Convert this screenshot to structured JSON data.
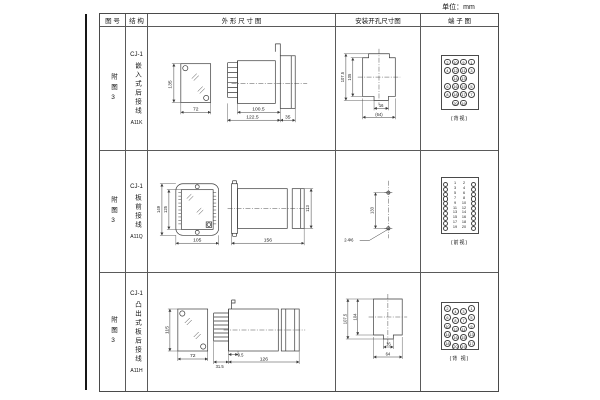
{
  "unit_label": "单位：mm",
  "header": {
    "col_fig": "图 号",
    "col_struct": "结 构",
    "col_outline": "外 形 尺 寸 图",
    "col_install": "安装开孔尺寸图",
    "col_terminal": "端 子 图"
  },
  "rows": [
    {
      "fig_no": "附图3",
      "model": "CJ-1",
      "mount": "嵌入式后接线",
      "code": "A11K",
      "outline": {
        "front_h": "135",
        "front_w": "72",
        "d1": "100.5",
        "d2": "122.5",
        "d3": "35"
      },
      "install": {
        "h1": "107.5",
        "h2": "105",
        "w1": "16",
        "w2": "(64)"
      },
      "terminal": {
        "caption": "(背视)",
        "grid": [
          "2",
          "10",
          "9",
          "1",
          "4",
          "12",
          "11",
          "3",
          "",
          "14",
          "13",
          "",
          "6",
          "16",
          "15",
          "5",
          "8",
          "18",
          "17",
          "7",
          "",
          "20",
          "19",
          ""
        ]
      }
    },
    {
      "fig_no": "附图3",
      "model": "CJ-1",
      "mount": "板前接线",
      "code": "A11Q",
      "outline": {
        "h1": "149",
        "h2": "125",
        "front_w": "105",
        "side_l": "156",
        "side_h": "113"
      },
      "install": {
        "h": "133",
        "hole": "2-Φ6"
      },
      "terminal": {
        "caption": "(前视)",
        "numbers": [
          "1",
          "2",
          "3",
          "4",
          "5",
          "6",
          "7",
          "8",
          "9",
          "10",
          "11",
          "12",
          "13",
          "14",
          "15",
          "16",
          "17",
          "18",
          "19",
          "20"
        ]
      }
    },
    {
      "fig_no": "附图3",
      "model": "CJ-1",
      "mount": "凸出式板后接线",
      "code": "A11H",
      "outline": {
        "front_h": "115",
        "front_w": "72",
        "d1": "31.5",
        "d2": "9.5",
        "d3": "126"
      },
      "install": {
        "h1": "107.5",
        "h2": "104",
        "w1": "16",
        "w2": "64"
      },
      "terminal": {
        "caption": "(背 视)",
        "grid": [
          "2",
          "4",
          "3",
          "1",
          "6",
          "8",
          "7",
          "5",
          "10",
          "12",
          "11",
          "9",
          "14",
          "16",
          "15",
          "13",
          "18",
          "20",
          "19",
          "17"
        ]
      }
    }
  ]
}
